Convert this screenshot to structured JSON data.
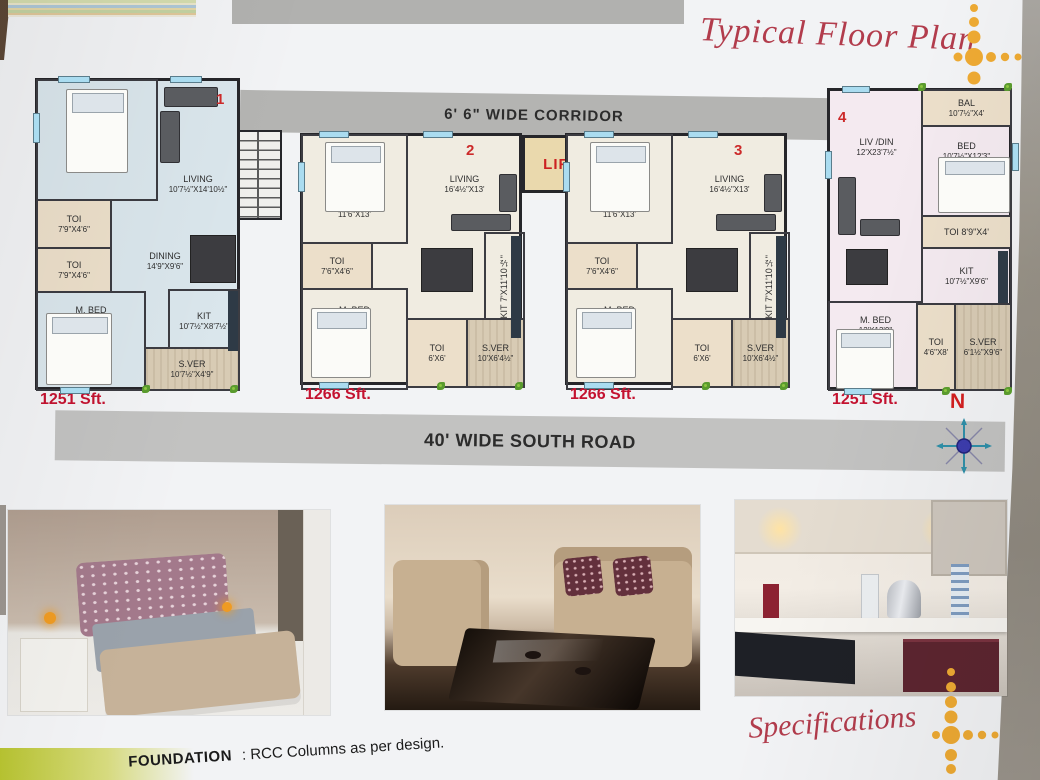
{
  "header": {
    "title": "Typical Floor Plan"
  },
  "plan": {
    "corridor_label": "6' 6\" WIDE CORRIDOR",
    "lift_label": "LIFT",
    "road_label": "40' WIDE SOUTH ROAD",
    "compass_label": "N"
  },
  "units": [
    {
      "number": "1",
      "area": "1251 Sft.",
      "rooms": [
        {
          "name": "BED",
          "dim": "12'X13'6\""
        },
        {
          "name": "LIVING",
          "dim": "10'7½\"X14'10½\""
        },
        {
          "name": "TOI",
          "dim": "7'9\"X4'6\""
        },
        {
          "name": "TOI",
          "dim": "7'9\"X4'6\""
        },
        {
          "name": "DINING",
          "dim": "14'9\"X9'6\""
        },
        {
          "name": "M. BED",
          "dim": "12'X14'1½\""
        },
        {
          "name": "KIT",
          "dim": "10'7½\"X8'7½\""
        },
        {
          "name": "S.VER",
          "dim": "10'7½\"X4'9\""
        }
      ]
    },
    {
      "number": "2",
      "area": "1266 Sft.",
      "rooms": [
        {
          "name": "BED",
          "dim": "11'6\"X13'"
        },
        {
          "name": "LIVING",
          "dim": "16'4½\"X13'"
        },
        {
          "name": "TOI",
          "dim": "7'6\"X4'6\""
        },
        {
          "name": "DINING",
          "dim": "9'X11'6\""
        },
        {
          "name": "M. BED",
          "dim": "11'6\"X13'"
        },
        {
          "name": "KIT",
          "dim": "7'X11'10½\""
        },
        {
          "name": "TOI",
          "dim": "6'X6'"
        },
        {
          "name": "S.VER",
          "dim": "10'X6'4½\""
        }
      ]
    },
    {
      "number": "3",
      "area": "1266 Sft.",
      "rooms": [
        {
          "name": "BED",
          "dim": "11'6\"X13'"
        },
        {
          "name": "LIVING",
          "dim": "16'4½\"X13'"
        },
        {
          "name": "TOI",
          "dim": "7'6\"X4'6\""
        },
        {
          "name": "DINING",
          "dim": "9'X11'6\""
        },
        {
          "name": "M. BED",
          "dim": "11'6\"X13'"
        },
        {
          "name": "KIT",
          "dim": "7'X11'10½\""
        },
        {
          "name": "TOI",
          "dim": "6'X6'"
        },
        {
          "name": "S.VER",
          "dim": "10'X6'4½\""
        }
      ]
    },
    {
      "number": "4",
      "area": "1251 Sft.",
      "rooms": [
        {
          "name": "BAL",
          "dim": "10'7½\"X4'"
        },
        {
          "name": "LIV /DIN",
          "dim": "12'X23'7½\""
        },
        {
          "name": "BED",
          "dim": "10'7½\"X12'3\""
        },
        {
          "name": "TOI",
          "dim": "8'9\"X4'"
        },
        {
          "name": "KIT",
          "dim": "10'7½\"X9'6\""
        },
        {
          "name": "M. BED",
          "dim": "12'X13'9\""
        },
        {
          "name": "TOI",
          "dim": "4'6\"X8'"
        },
        {
          "name": "S.VER",
          "dim": "6'1½\"X9'6\""
        }
      ]
    }
  ],
  "photos": [
    {
      "name": "bedroom interior"
    },
    {
      "name": "living room interior"
    },
    {
      "name": "kitchen interior"
    }
  ],
  "footer": {
    "specifications_title": "Specifications",
    "foundation_label": "FOUNDATION",
    "foundation_value": ": RCC Columns as per design."
  },
  "colors": {
    "title_red": "#b23c4c",
    "sft_red": "#c41230",
    "dot_orange": "#eeaa33",
    "corridor_gray": "#b4b4b2",
    "road_gray": "#c2c2c1",
    "unit1_fill": "#dae6ec",
    "unit23_fill": "#f0ece1",
    "unit4_fill": "#f4eaf0",
    "wall": "#26262a",
    "lift_fill": "#ead9ad",
    "lift_text": "#cc2222",
    "window_blue": "#aadcf0",
    "compass_red": "#d31f1f"
  }
}
